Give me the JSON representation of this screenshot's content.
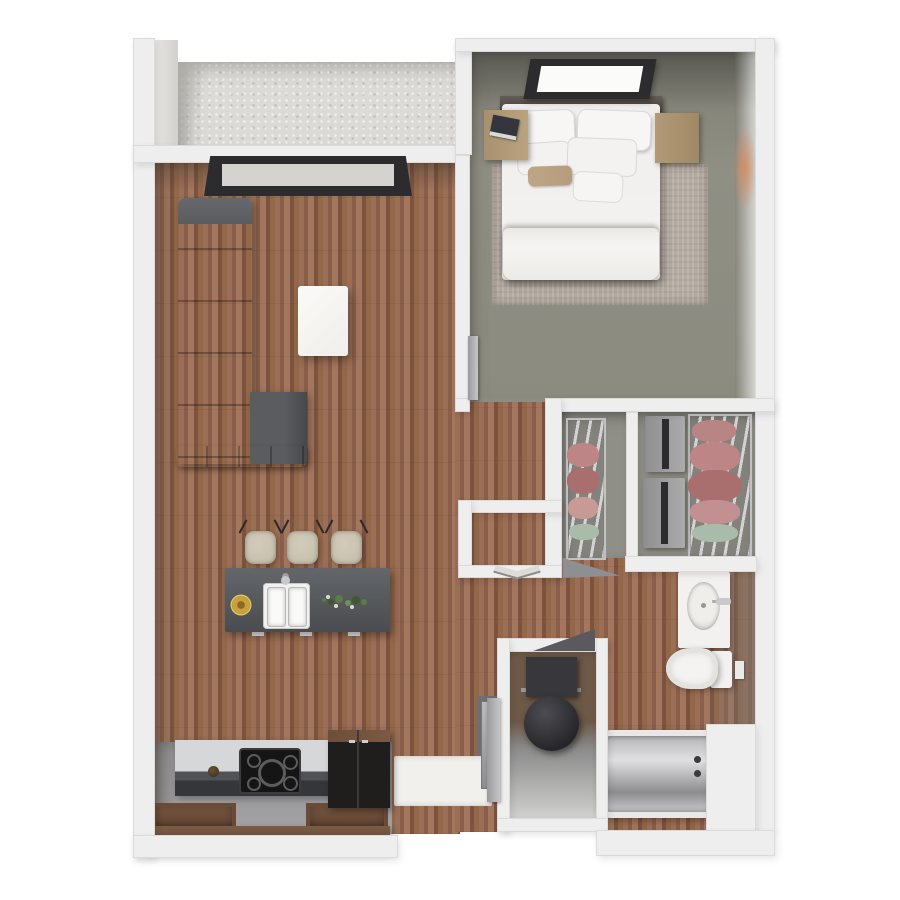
{
  "scene": {
    "type": "3d-floor-plan-render",
    "description": "Top-down 3D architectural rendering of a one-bedroom, one-bath apartment with balcony; no text labels are rendered in the image",
    "rooms": [
      {
        "name": "balcony",
        "floor": "concrete",
        "features": [
          "concrete-slab"
        ]
      },
      {
        "name": "living-room",
        "floor": "hardwood",
        "furniture": [
          "l-shaped-sectional-sofa",
          "white-coffee-table",
          "window-to-balcony"
        ]
      },
      {
        "name": "kitchen",
        "floor": "gray-tile",
        "furniture": [
          "island-with-double-sink",
          "bar-stool",
          "bar-stool",
          "bar-stool",
          "cooktop-counter",
          "refrigerator",
          "lower-wood-cabinets"
        ]
      },
      {
        "name": "bedroom",
        "floor": "gray-green",
        "furniture": [
          "double-bed-white-bedding",
          "nightstand-left",
          "nightstand-right",
          "area-rug",
          "window"
        ]
      },
      {
        "name": "hallway",
        "floor": "hardwood",
        "furniture": [
          "coat-closet-with-bifold-doors"
        ]
      },
      {
        "name": "walk-in-closet-left",
        "floor": "gray",
        "furniture": [
          "wire-shelving-with-clothes"
        ]
      },
      {
        "name": "walk-in-closet-right",
        "floor": "gray",
        "furniture": [
          "dresser",
          "dresser",
          "wire-shelving-with-clothes"
        ]
      },
      {
        "name": "bathroom",
        "floor": "hardwood",
        "furniture": [
          "vanity-with-oval-sink",
          "toilet",
          "bathtub-with-faucet"
        ]
      },
      {
        "name": "utility-closet",
        "furniture": [
          "water-heater",
          "storage-niche"
        ]
      },
      {
        "name": "entry",
        "furniture": [
          "white-door-mat",
          "entry-door-leaf"
        ]
      }
    ],
    "palette": {
      "bg": "#ffffff",
      "wall": "#efeeee",
      "wallEdge": "#dcdbd9",
      "wood1": "#9a6e57",
      "wood2": "#8a5f49",
      "wood3": "#a3765e",
      "wood4": "#7d5340",
      "wood5": "#936849",
      "concrete": "#dbdad6",
      "bedroomFloor": "#8b8b80",
      "closetFloor": "#8f8e87",
      "kitchenFloor": "#9a999b",
      "rug": "#b4aba2",
      "sofa": "#5b5c60",
      "sofaDark": "#4b4c50",
      "island": "#4a4c4f",
      "counterTop": "#d6d7d9",
      "cabinetDark": "#353639",
      "applianceBlack": "#201e1d",
      "fridgeWoodTop": "#7a5a43",
      "cabinetWood": "#5a4030",
      "cabinetWoodTop": "#7d5c44",
      "stool": "#c4bcab",
      "plateYellow": "#c8a03c",
      "garnishGreen": "#5d7a48",
      "clothesPink": "#bd8585",
      "clothesPinkDark": "#a96e6e",
      "clothesGreen": "#a9bba9",
      "heater": "#26262a",
      "windowFrame": "#2c2c2e",
      "accentOrange": "#d68a5c",
      "chrome": "#c9c9cb",
      "tanPillow": "#b59c7d"
    }
  }
}
